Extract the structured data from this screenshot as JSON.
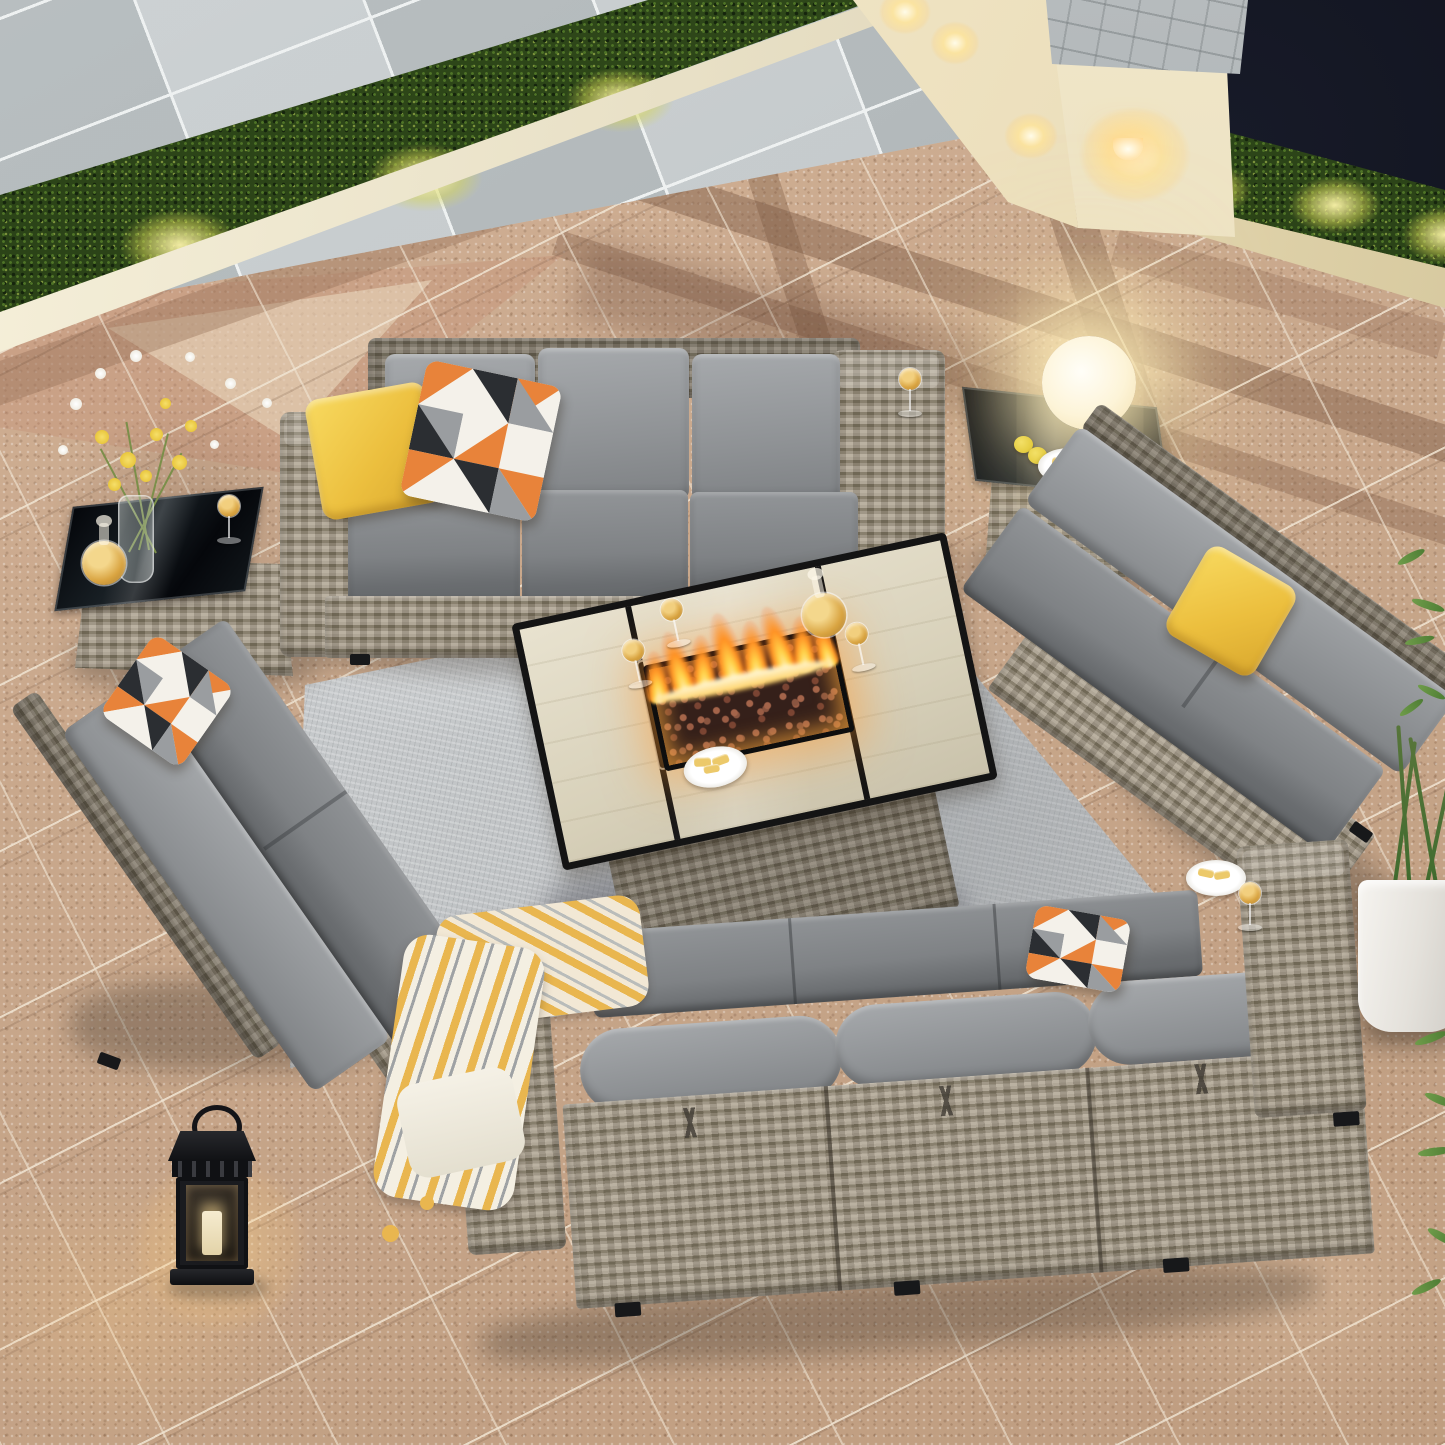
{
  "scene": {
    "label": "night patio with gray wicker conversation set around a lit fire pit table",
    "aria": "Aerial night view of an outdoor patio furniture set: gray rattan sofas and loveseats with dark gray cushions and yellow accent pillows arranged on a gray area rug around a rectangular propane fire pit table with flames, beside a pool deck, lit hedges and a cream planter wall"
  },
  "palette": {
    "paver": "#c7a489",
    "paver_dark": "#8d6c55",
    "deck": "#c3c8ca",
    "hedge": "#2c4519",
    "night": "#0b0d15",
    "cream_wall": "#ece3c9",
    "stone_cap": "#a3a8aa",
    "curb": "#efe8d6",
    "wicker": "#a19886",
    "wicker_dark": "#6e6557",
    "cushion": "#84878a",
    "cushion_light": "#9b9ea1",
    "rug": "#c6c9cb",
    "pillow_yellow": "#f0c83c",
    "pillow_orange": "#e8833a",
    "pillow_black": "#2b2e32",
    "flame": "#ff9e2e",
    "flame_core": "#fff3b0",
    "lava": "#8a5540",
    "amber": "#d9a441",
    "glass_black": "#101214",
    "lamp_glow": "#ffedbe",
    "plant_green": "#5d8a3c",
    "blanket_yellow": "#e9b64f",
    "table_tile": "#ddd6c2"
  },
  "objects": {
    "pool_deck": "stone pool deck",
    "hedge": "boxwood hedge with uplights",
    "night_sky": "dark night background",
    "planter_wall": "cream planter wall with stone cap and sconce",
    "patio_floor": "tan paver patio floor",
    "area_rug": "light gray area rug",
    "top_sofa": "3-seat wicker sofa with gray cushions",
    "bottom_sofa": "3-seat wicker sofa seen from behind",
    "left_loveseat": "armless 2-seat wicker loveseat",
    "right_loveseat": "armless 2-seat wicker loveseat",
    "left_side_table": "wicker side table with black glass top",
    "right_side_table": "wicker side table with black glass top",
    "fire_pit_table": "rectangular fire pit table with tile top and flames",
    "globe_lamp": "glowing globe lamp",
    "flower_vase": "glass vase with yellow and white flowers",
    "wine_decanter": "round decanter with amber drink",
    "wine_glass": "wine glass with amber drink",
    "snack_bowl": "white bowl of chips",
    "snack_plate": "white plate of crackers",
    "lemons": "two lemons",
    "candle_lantern": "black candle lantern",
    "throw_blanket": "yellow and white patterned throw blanket",
    "yellow_pillow": "yellow throw pillow",
    "geometric_pillow": "orange black and gray triangle pillow",
    "potted_plant": "white planter pot with green plant",
    "flames": "gas flames over lava rocks"
  }
}
